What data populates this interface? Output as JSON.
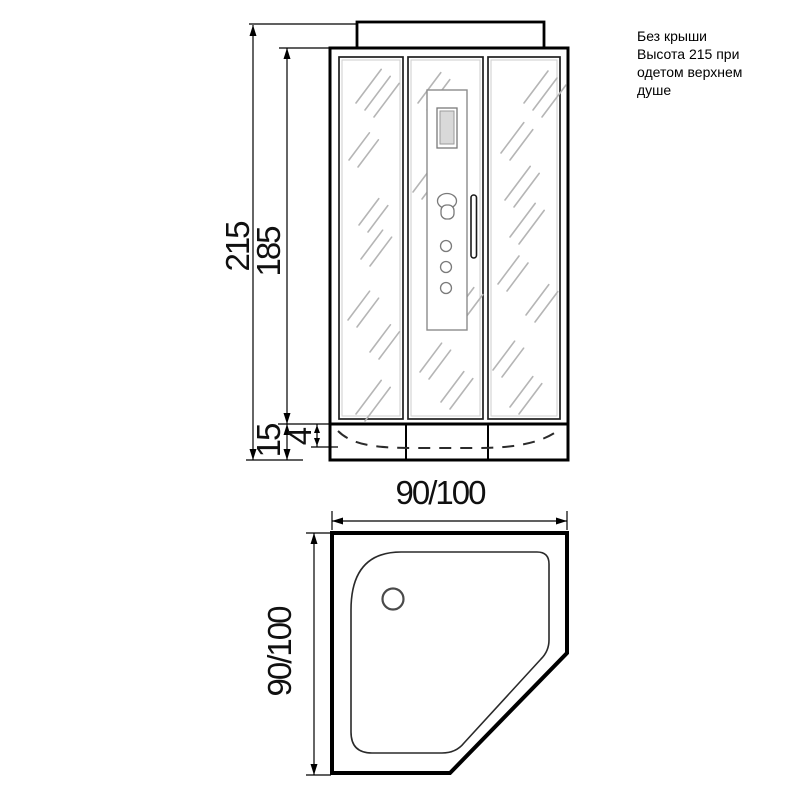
{
  "annotation": {
    "note": "Без крыши\nВысота 215 при\nодетом верхнем\nдуше"
  },
  "front_view": {
    "dimensions": {
      "total_height": "215",
      "glass_height": "185",
      "tray_height": "15",
      "tray_rim": "4"
    }
  },
  "top_view": {
    "dimensions": {
      "width": "90/100",
      "depth": "90/100"
    }
  }
}
